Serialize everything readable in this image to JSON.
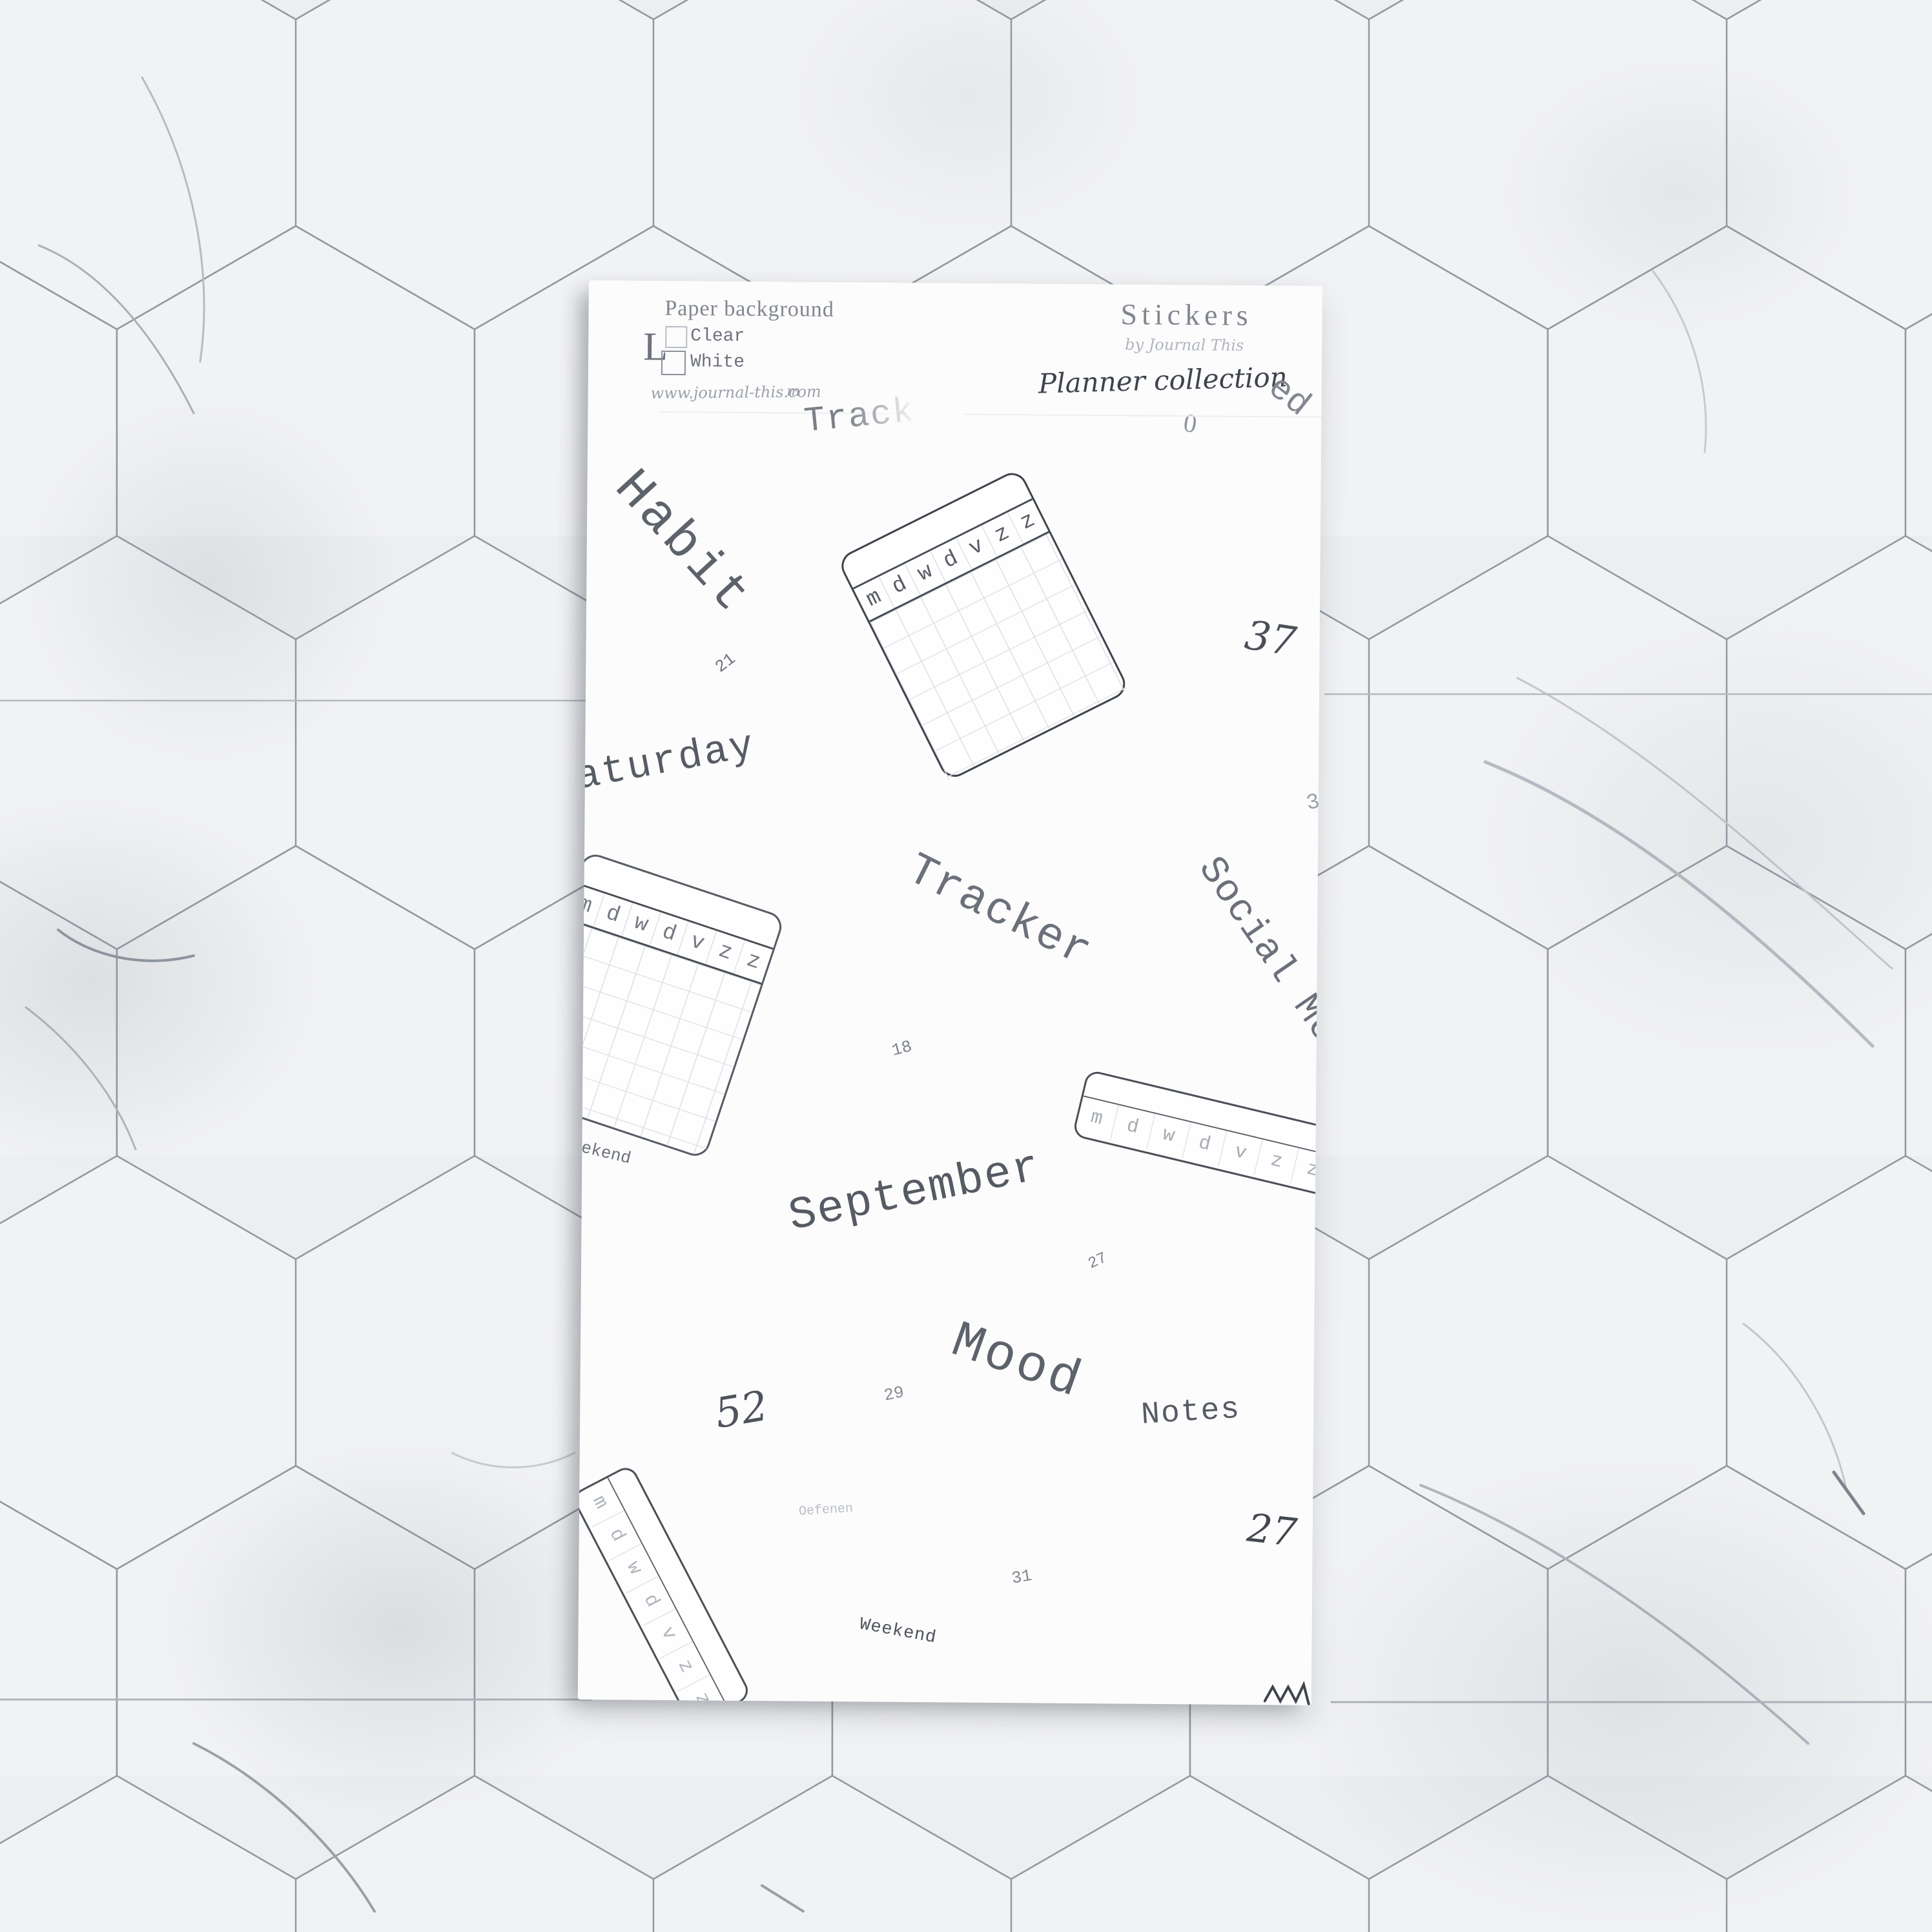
{
  "product_sheet": {
    "info_left": {
      "title": "Paper background",
      "corner_mark": "L",
      "options": [
        "Clear",
        "White"
      ],
      "website": "www.journal-this.com"
    },
    "info_right": {
      "brand": "Stickers",
      "byline": "by Journal This",
      "collection": "Planner collection",
      "stray_digit": "0",
      "edge_word": "ed"
    }
  },
  "calendar": {
    "day_labels": [
      "m",
      "d",
      "w",
      "d",
      "v",
      "z",
      "z"
    ]
  },
  "words": {
    "top_cut": "Tracker",
    "tiny_m": "m",
    "habit": "Habit",
    "saturday": "Saturday",
    "tracker": "Tracker",
    "social_media": "Social Me",
    "september": "September",
    "mood": "Mood",
    "notes": "Notes",
    "weekend_side": "Weekend",
    "weekend_bottom": "Weekend",
    "oefenen": "Oefenen"
  },
  "numbers": {
    "n21": "21",
    "n37": "37",
    "n3_edge": "3",
    "n18": "18",
    "n27_mid": "27",
    "n52": "52",
    "n29": "29",
    "n31": "31",
    "n27_big": "27"
  },
  "colors": {
    "ink_dark": "#42474f",
    "ink": "#60656e",
    "ink_light": "#8a8f98",
    "ink_faint": "#b2b7bf",
    "tile_grout": "#9298a0",
    "sheet": "#fcfcfd"
  }
}
